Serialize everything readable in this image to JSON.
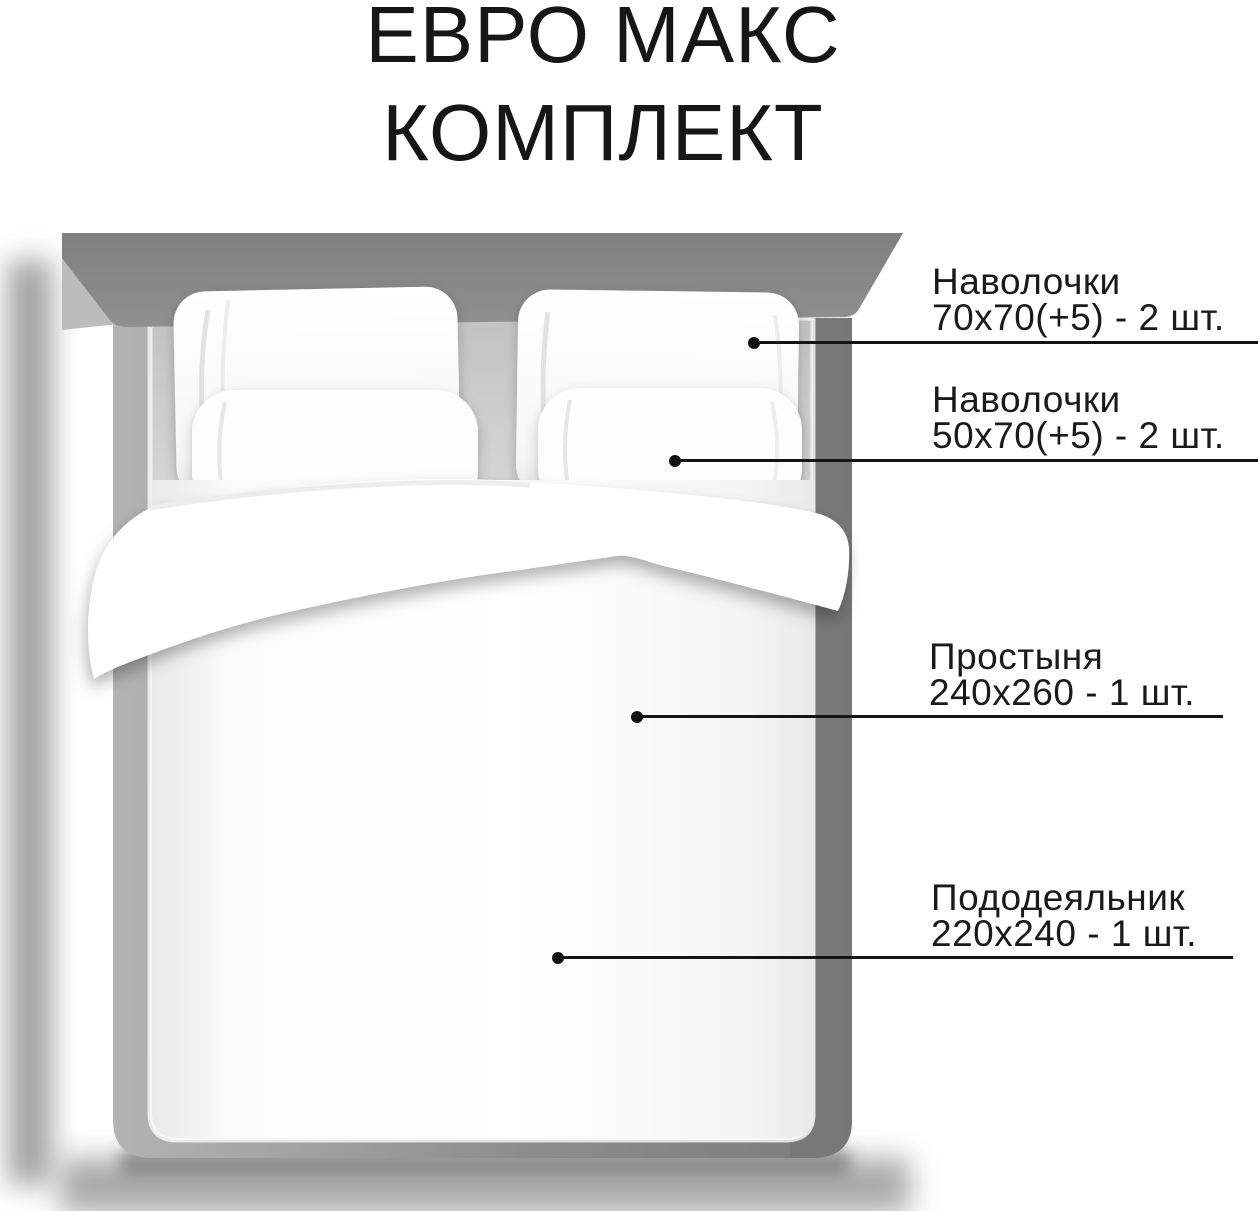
{
  "title": {
    "line1": "ЕВРО МАКС",
    "line2": "КОМПЛЕКТ"
  },
  "callouts": [
    {
      "item": "Наволочки",
      "size": "70х70(+5) - 2 шт."
    },
    {
      "item": "Наволочки",
      "size": "50х70(+5) - 2 шт."
    },
    {
      "item": "Простыня",
      "size": "240х260 - 1 шт."
    },
    {
      "item": "Пододеяльник",
      "size": "220х240 - 1 шт."
    }
  ],
  "colors": {
    "text": "#1a1a1a",
    "callout_line": "#141414",
    "headboard_gray": "#868686",
    "frame_gray": "#828282",
    "shadow_gray": "#8f8f8f",
    "bedding_white": "#ffffff"
  }
}
